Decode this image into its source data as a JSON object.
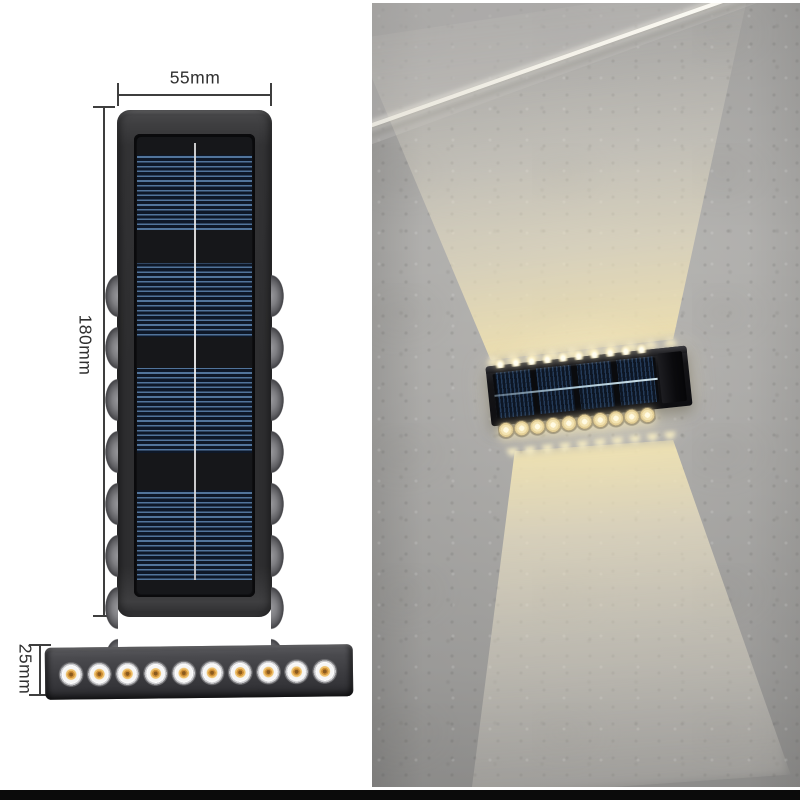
{
  "diagram": {
    "width_label": "55mm",
    "height_label": "180mm",
    "depth_label": "25mm",
    "top_view": {
      "led_bumps_per_side": 8,
      "solar_cell_blocks": 4,
      "body_color": "#3a3a3d",
      "panel_stripe_color": "#51749b",
      "panel_background": "#10151d"
    },
    "side_view": {
      "led_count": 10,
      "led_chip_color": "#d3923a",
      "body_color": "#47474b"
    }
  },
  "photo": {
    "scene": "solar-led-wall-lamp-on-concrete-wall",
    "wall_color": "#b3b2b0",
    "beam_color": "#f0e2b0",
    "fixture": {
      "solar_cell_blocks": 4,
      "top_led_count": 10,
      "bottom_led_count": 10,
      "housing_color": "#131316"
    }
  },
  "footer": {
    "bar_color": "#0b0b0b"
  }
}
